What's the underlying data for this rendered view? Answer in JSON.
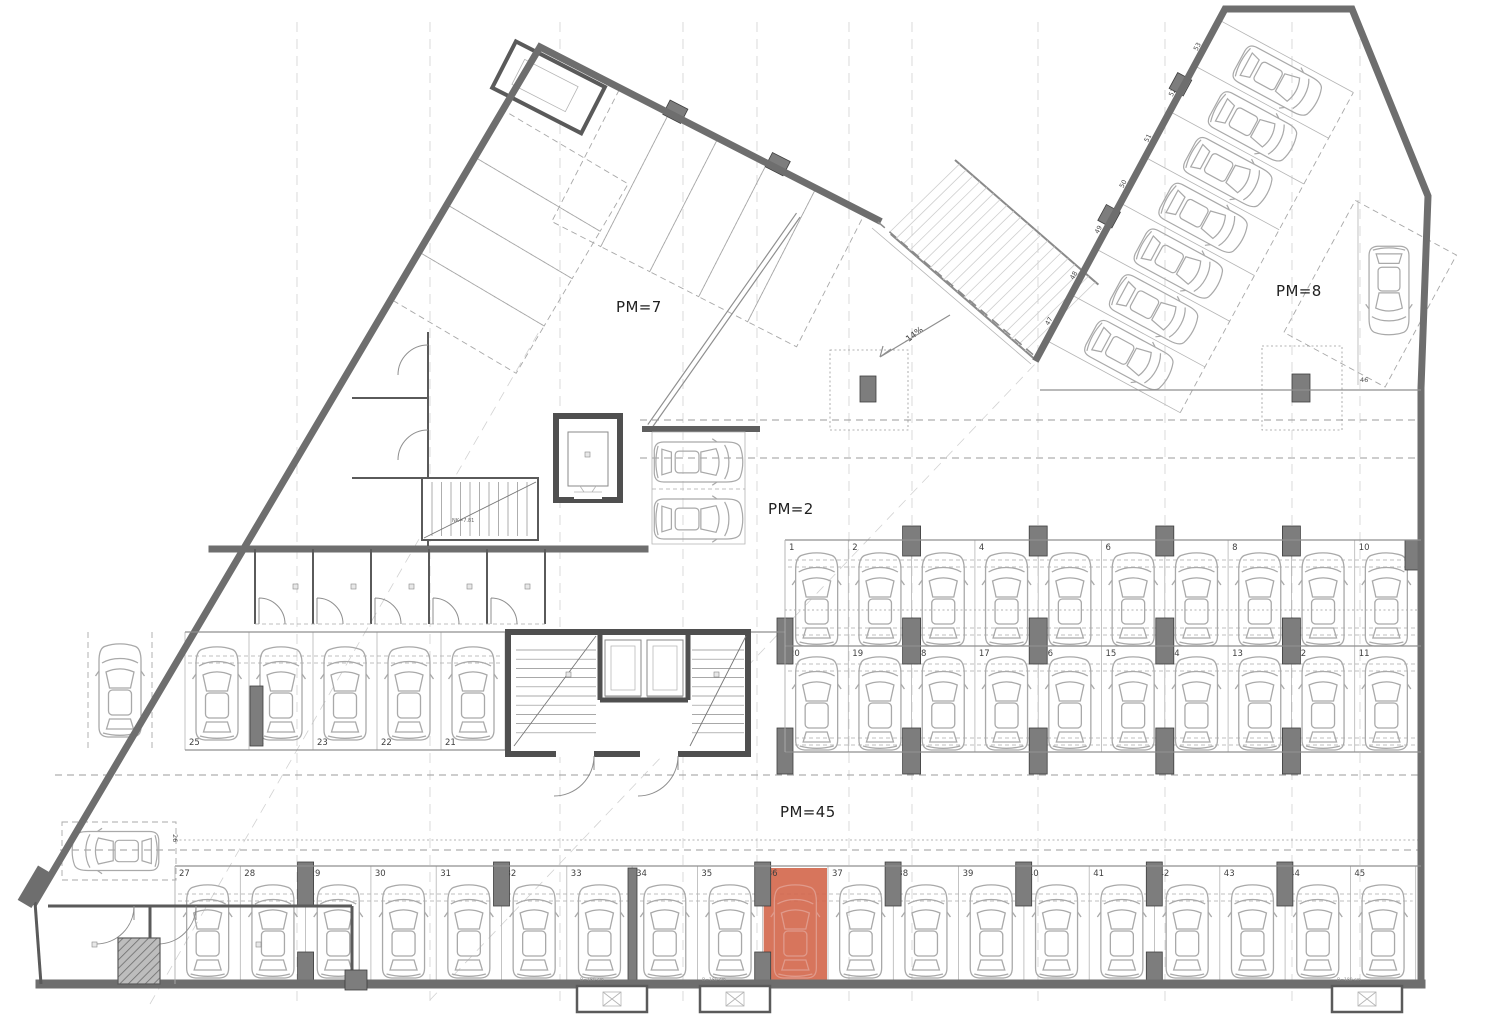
{
  "labels": {
    "pm7": "PM=7",
    "pm2": "PM=2",
    "pm8": "PM=8",
    "pm45": "PM=45",
    "slope": "-14%",
    "stair_note": "NK=7.81",
    "depth_note": "B=180 cm"
  },
  "spaces": {
    "row_top": [
      "1",
      "2",
      "3",
      "4",
      "5",
      "6",
      "7",
      "8",
      "9",
      "10"
    ],
    "row_mid": [
      "20",
      "19",
      "18",
      "17",
      "16",
      "15",
      "14",
      "13",
      "12",
      "11"
    ],
    "row_left": [
      "25",
      "24",
      "23",
      "22",
      "21"
    ],
    "row_bottom": [
      "27",
      "28",
      "29",
      "30",
      "31",
      "32",
      "33",
      "34",
      "35",
      "36",
      "37",
      "38",
      "39",
      "40",
      "41",
      "42",
      "43",
      "44",
      "45"
    ],
    "row_diagonal": [
      "47",
      "48",
      "49",
      "50",
      "51",
      "52",
      "53"
    ],
    "single_left": "26",
    "single_right": "46"
  },
  "highlight": {
    "space": "36",
    "color": "#d4694e"
  },
  "colors": {
    "wall": "#6e6e6e",
    "wall_dark": "#4f4f4f",
    "column": "#7d7d7d",
    "car_outline": "#a9a9a9",
    "dashed_guide": "#9b9b9b",
    "text": "#3a3a3a",
    "background": "#ffffff",
    "highlight": "#d4694e"
  }
}
